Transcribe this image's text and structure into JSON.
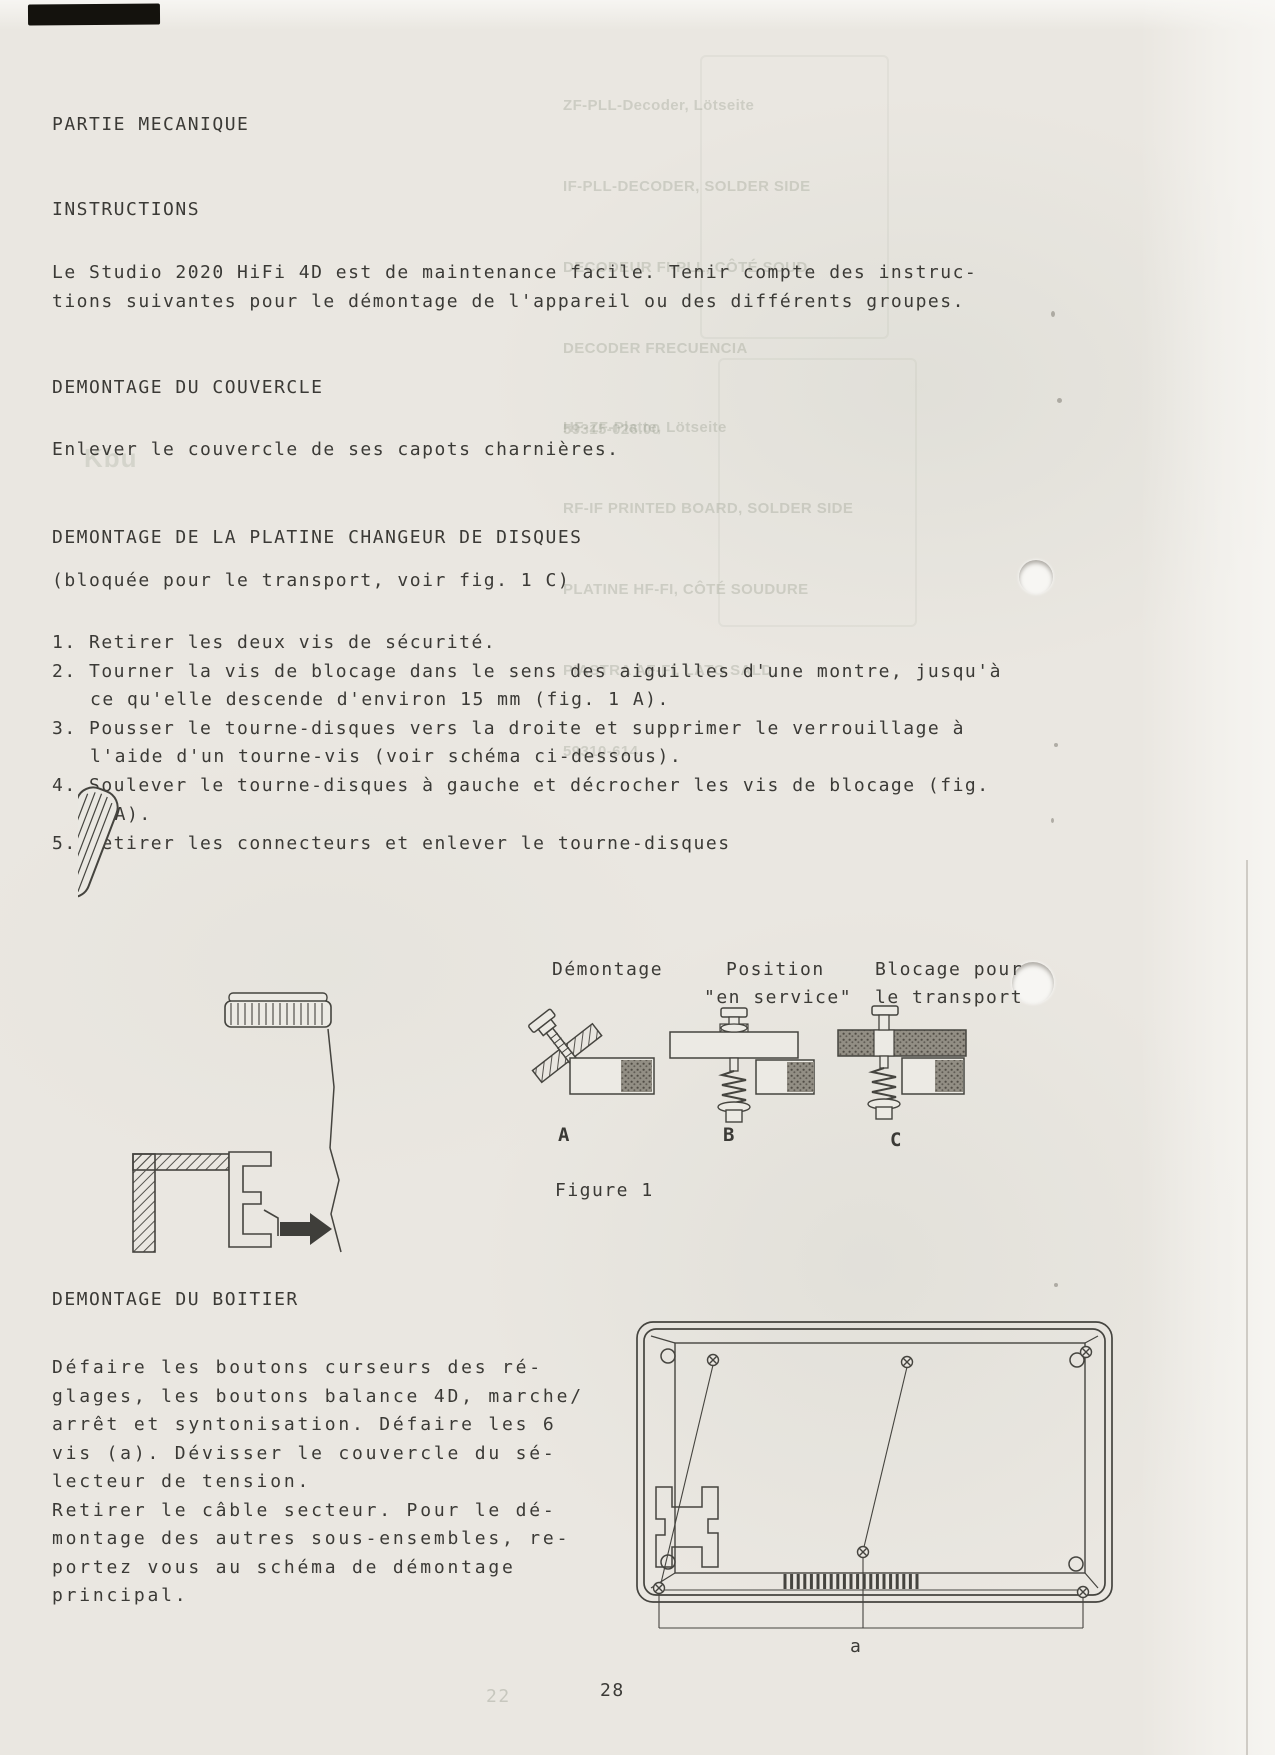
{
  "page": {
    "number": "28"
  },
  "partie": {
    "title": "PARTIE MECANIQUE"
  },
  "instructions": {
    "title": "INSTRUCTIONS",
    "lines": [
      "Le Studio 2020 HiFi 4D est de maintenance facile. Tenir compte des instruc-",
      "tions suivantes pour le démontage de l'appareil ou des différents groupes."
    ]
  },
  "couvercle": {
    "title": "DEMONTAGE DU COUVERCLE",
    "body": "Enlever le couvercle de ses capots charnières."
  },
  "platine": {
    "title": "DEMONTAGE DE LA PLATINE CHANGEUR DE DISQUES",
    "note": "(bloquée pour le transport, voir fig. 1 C)",
    "steps": [
      "1. Retirer les deux vis de sécurité.",
      "2. Tourner la vis de blocage dans le sens des aiguilles d'une montre, jusqu'à",
      "ce qu'elle descende d'environ 15 mm (fig. 1 A).",
      "3. Pousser le tourne-disques vers la droite et supprimer le verrouillage à",
      "l'aide d'un tourne-vis (voir schéma ci-dessous).",
      "4. Soulever le tourne-disques à gauche et décrocher les vis de blocage (fig.",
      "1 A).",
      "5. Retirer les connecteurs et enlever le tourne-disques"
    ]
  },
  "figure1": {
    "caption": "Figure 1",
    "col_a": {
      "label": "Démontage",
      "letter": "A"
    },
    "col_b": {
      "label1": "Position",
      "label2": "\"en service\"",
      "letter": "B"
    },
    "col_c": {
      "label1": "Blocage pour",
      "label2": "le transport",
      "letter": "C"
    }
  },
  "boitier": {
    "title": "DEMONTAGE DU BOITIER",
    "lines": [
      "Défaire les boutons curseurs des ré-",
      "glages, les boutons balance 4D, marche/",
      "arrêt et syntonisation. Défaire les 6",
      "vis (a). Dévisser le couvercle du sé-",
      "lecteur de tension.",
      "Retirer le câble secteur. Pour le dé-",
      "montage des autres sous-ensembles, re-",
      "portez vous au schéma de démontage",
      "principal."
    ]
  },
  "figure2": {
    "screw_label": "a"
  },
  "ghost": {
    "block1": [
      "ZF-PLL-Decoder, Lötseite",
      "IF-PLL-DECODER, SOLDER SIDE",
      "DECODEUR FI-PLL, CÔTÉ SOUD.",
      "DECODER FRECUENCIA",
      "59315-026.00"
    ],
    "block2": [
      "HF-ZF-Platte, Lötseite",
      "RF-IF PRINTED BOARD, SOLDER SIDE",
      "PLATINE HF-FI, CÔTÉ SOUDURE",
      "PIASTRA AF-FI, LATO SALD.",
      "59310-614."
    ],
    "mark1": "Kbu",
    "mark2": "22"
  }
}
